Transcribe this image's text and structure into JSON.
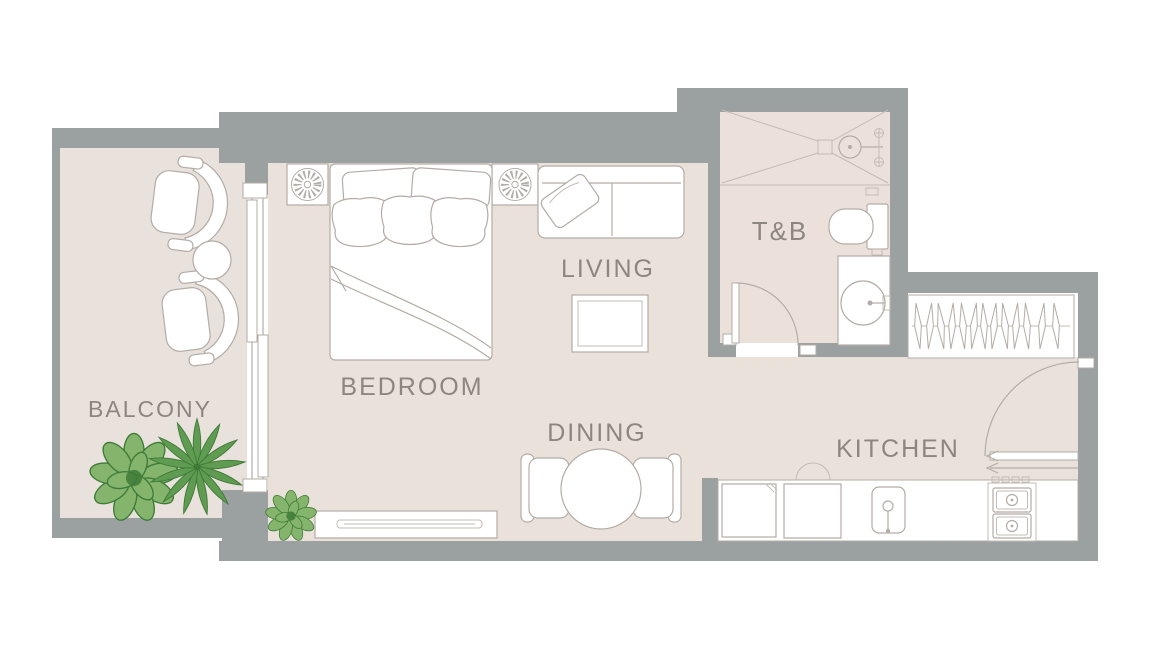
{
  "plan": {
    "rooms": [
      {
        "id": "balcony",
        "label": "BALCONY",
        "furniture": [
          "lounge-chair",
          "lounge-chair",
          "round-side-table",
          "bush-plant",
          "palm-plant"
        ]
      },
      {
        "id": "bedroom",
        "label": "BEDROOM",
        "furniture": [
          "double-bed",
          "nightstand-with-lamp",
          "nightstand-with-lamp",
          "tv-console",
          "small-plant",
          "sliding-glass-door"
        ]
      },
      {
        "id": "living",
        "label": "LIVING",
        "furniture": [
          "sofa",
          "coffee-table"
        ]
      },
      {
        "id": "dining",
        "label": "DINING",
        "furniture": [
          "round-dining-table",
          "dining-chair",
          "dining-chair"
        ]
      },
      {
        "id": "toilet_bath",
        "label": "T&B",
        "furniture": [
          "shower-area",
          "shower-head",
          "toilet",
          "vanity-sink",
          "swing-door"
        ]
      },
      {
        "id": "kitchen",
        "label": "KITCHEN",
        "furniture": [
          "wardrobe-with-hangers",
          "entrance-door",
          "counter",
          "cabinet",
          "appliance",
          "kitchen-sink",
          "two-burner-stove"
        ]
      }
    ],
    "colors": {
      "wall": "#9ba1a0",
      "floor": "#eae1db",
      "floor_balcony": "#e9e1dc",
      "floor_bath": "#ece1da",
      "furniture_fill": "#ffffff",
      "furniture_line": "#b3aca6",
      "detail_line": "#c3bcb4",
      "label_text": "#8d8680",
      "plant_dark": "#3f7a38",
      "plant_mid": "#5f9b50",
      "plant_light": "#85b56d",
      "background": "#ffffff"
    }
  }
}
